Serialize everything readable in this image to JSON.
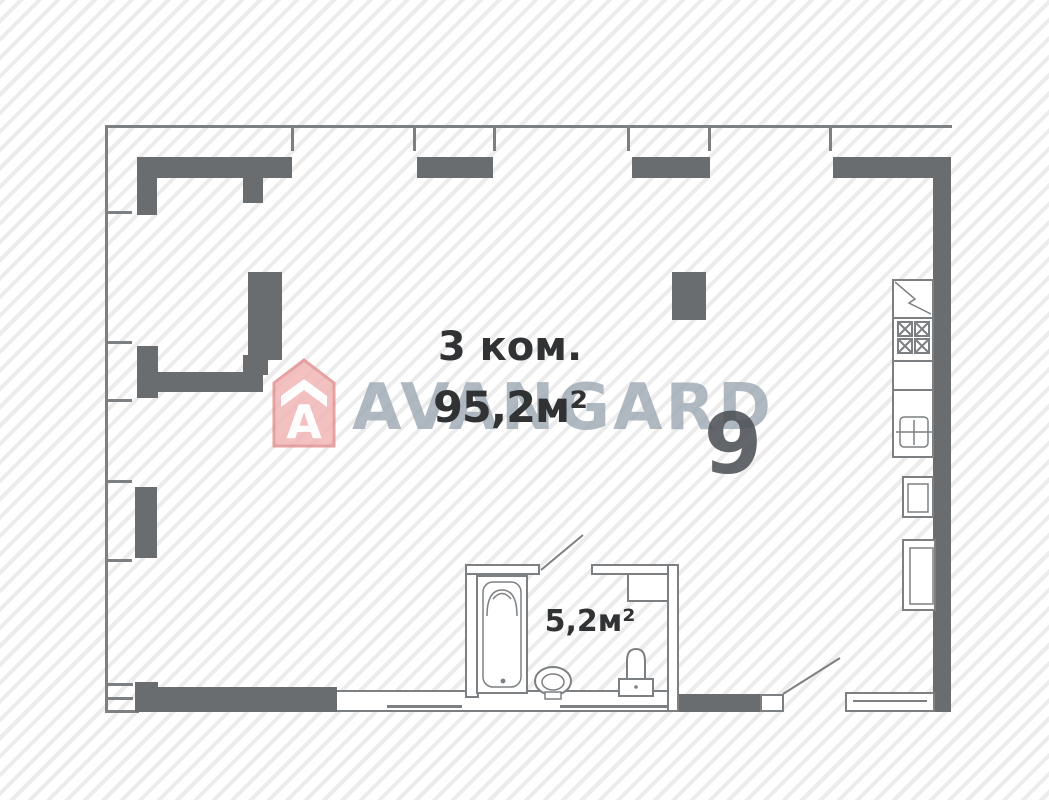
{
  "plan": {
    "room_label": "3 ком.",
    "total_area": "95,2м²",
    "bathroom_area": "5,2м²",
    "unit_number": "9"
  },
  "watermark": {
    "text": "AVANGARD",
    "logo_letter": "A"
  },
  "colors": {
    "wall": "#6a6d6f",
    "line": "#7d8083",
    "text": "#303234",
    "watermark": "#9aa6b1",
    "unit_number": "#4e5256",
    "logo_pink": "#f2b4b4",
    "logo_outline": "#e28f8f",
    "background_hatch": "#ececed"
  }
}
